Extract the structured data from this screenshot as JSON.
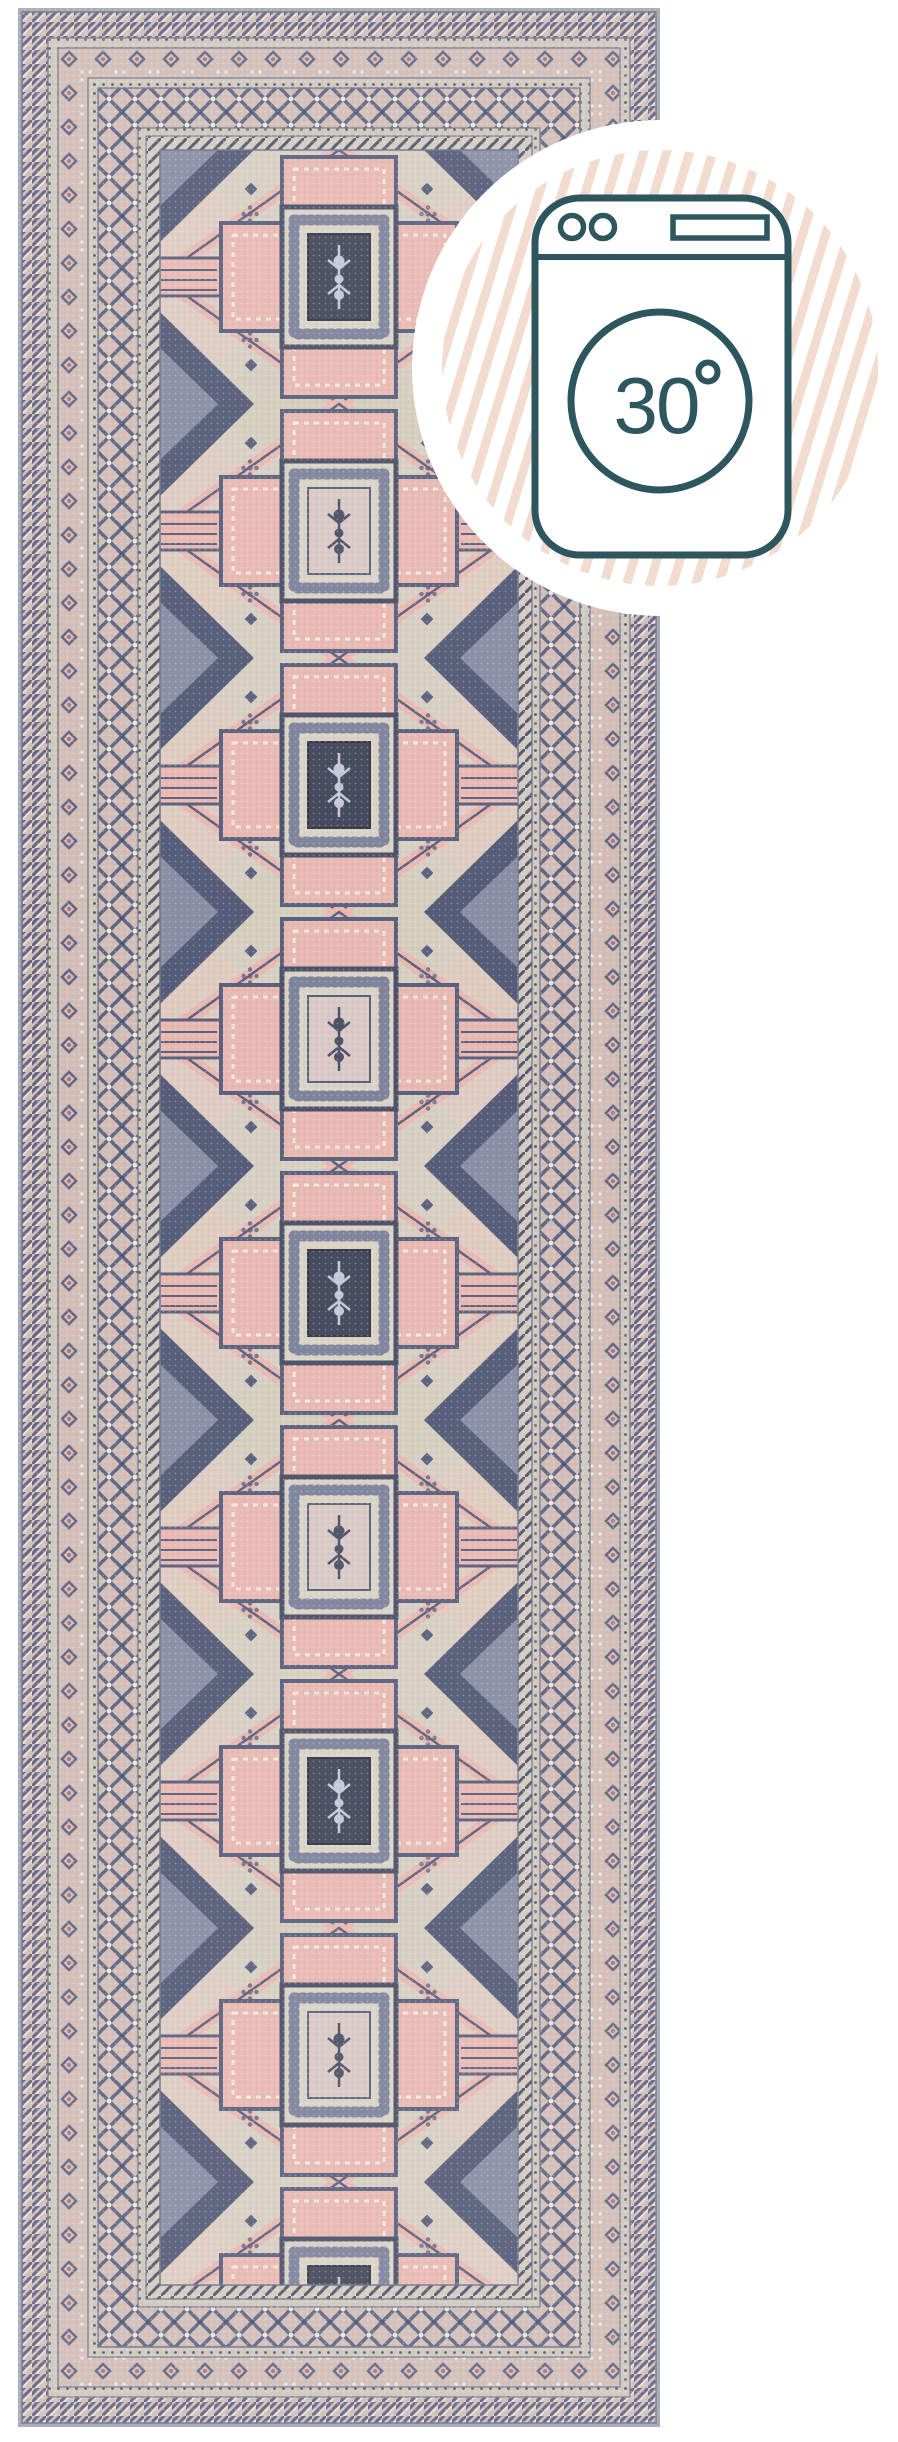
{
  "page": {
    "background_color": "#ffffff"
  },
  "badge": {
    "temperature_value": "30",
    "temperature_label": "30°",
    "icon": "washing-machine-icon",
    "outline_color": "#2d565f",
    "stripe_color": "#f2dcd0",
    "background_color": "#ffffff"
  },
  "rug": {
    "shape": "runner",
    "medallions": {
      "count": 9,
      "center_alternation": [
        "dark",
        "light"
      ]
    },
    "border_bands": [
      "rope-chevron",
      "dot-guard",
      "rosette-band",
      "dot-guard",
      "trellis-band",
      "dot-guard",
      "chevron-guard"
    ],
    "palette": {
      "field": "#d6cec1",
      "navy": "#565d7a",
      "dark_navy": "#3f4457",
      "pink": "#e8b7b0",
      "band_tan": "#d2bcb5",
      "guard": "#cfc7bb",
      "cream": "#d9d2c5",
      "edge": "#a0a4b0",
      "triangle": "#515874"
    }
  }
}
